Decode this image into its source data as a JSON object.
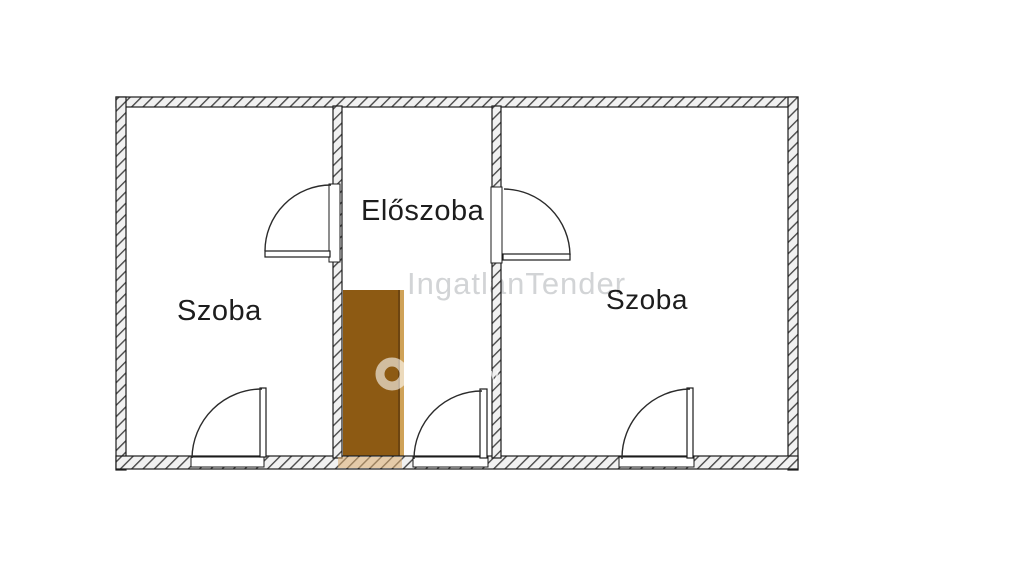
{
  "floor_plan": {
    "rooms": [
      {
        "name": "room-left",
        "label": "Szoba"
      },
      {
        "name": "hallway",
        "label": "Előszoba"
      },
      {
        "name": "room-right",
        "label": "Szoba"
      }
    ],
    "watermark": {
      "text": "IngatlanTender",
      "overlay_mark": "w",
      "ring_icon": "ring-icon"
    },
    "colors": {
      "wall_outline": "#1b1b1b",
      "wall_fill": "#f1f1f1",
      "furniture_brown": "#8d5a13",
      "furniture_brown_edge": "#6d4511",
      "furniture_brown_light": "#cfa258",
      "watermark_gray": "#d2d4d6",
      "label_text": "#1d1d1d",
      "background": "#ffffff"
    }
  }
}
